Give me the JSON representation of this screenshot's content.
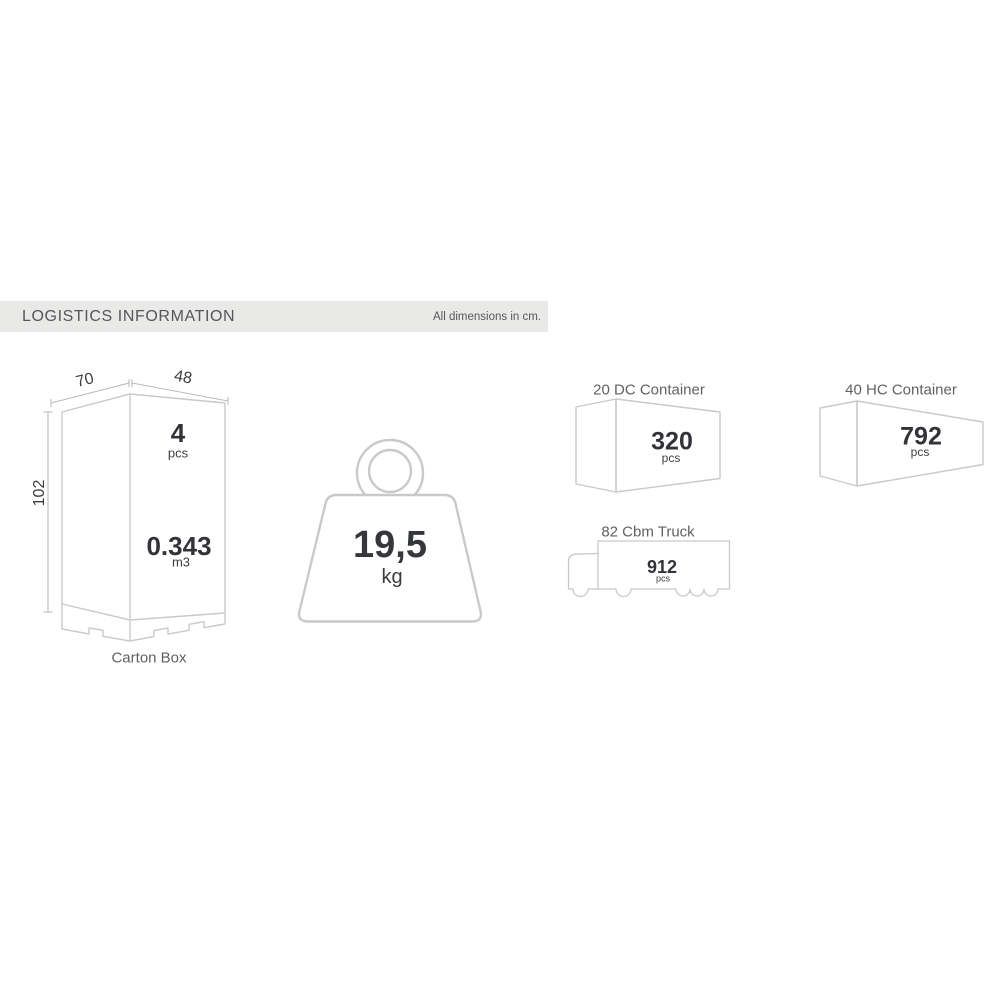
{
  "header": {
    "title": "LOGISTICS INFORMATION",
    "note": "All dimensions in cm."
  },
  "carton_box": {
    "label": "Carton Box",
    "width_cm": "70",
    "depth_cm": "48",
    "height_cm": "102",
    "quantity": "4",
    "quantity_unit": "pcs",
    "volume": "0.343",
    "volume_unit": "m3"
  },
  "weight": {
    "value": "19,5",
    "unit": "kg"
  },
  "container_20dc": {
    "title": "20 DC Container",
    "quantity": "320",
    "unit": "pcs"
  },
  "container_40hc": {
    "title": "40 HC Container",
    "quantity": "792",
    "unit": "pcs"
  },
  "truck": {
    "title": "82 Cbm Truck",
    "quantity": "912",
    "unit": "pcs"
  },
  "colors": {
    "line": "#c7c9cb",
    "dim_line": "#b9bbbd",
    "bar_bg": "#e9e9e7",
    "number_dark": "#313338",
    "caption_gray": "#5f6164"
  }
}
